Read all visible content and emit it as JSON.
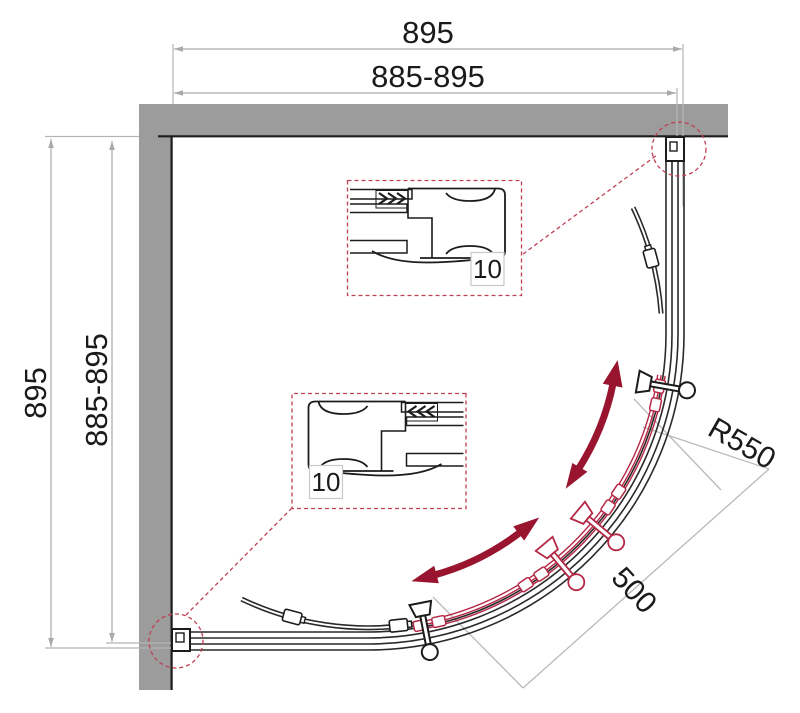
{
  "meta": {
    "title": "Quadrant shower enclosure plan drawing"
  },
  "dimensions": {
    "top_overall": "895",
    "top_adjust": "885-895",
    "left_overall": "895",
    "left_adjust": "885-895",
    "radius": "R550",
    "entry": "500",
    "detail_top": "10",
    "detail_bottom": "10"
  },
  "colors": {
    "wall": "#9c9c9c",
    "line": "#2a2a2a",
    "dim": "#a9a9a9",
    "door_red": "#b52845",
    "arrow_red": "#99152f",
    "callout_red": "#c04055"
  }
}
